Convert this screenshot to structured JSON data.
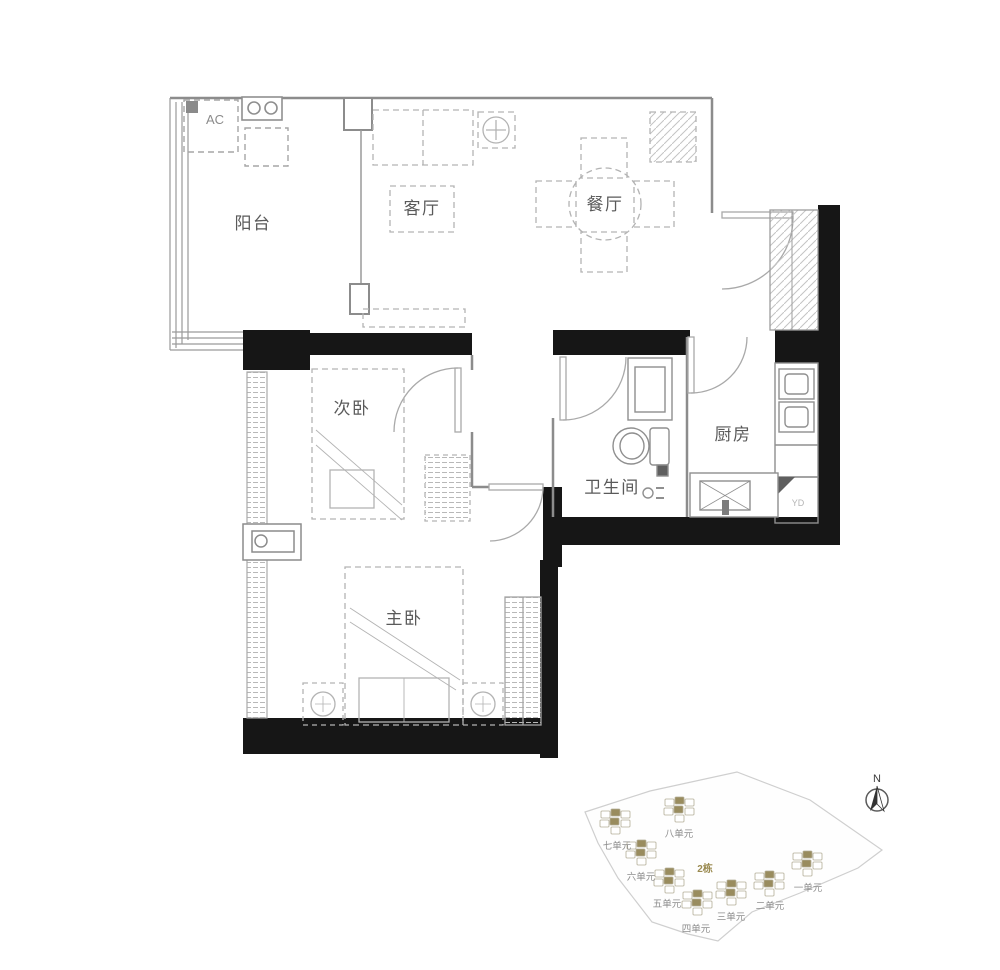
{
  "floor_plan": {
    "rooms": [
      {
        "id": "balcony",
        "label": "阳台"
      },
      {
        "id": "living-room",
        "label": "客厅"
      },
      {
        "id": "dining-room",
        "label": "餐厅"
      },
      {
        "id": "second-bedroom",
        "label": "次卧"
      },
      {
        "id": "bathroom",
        "label": "卫生间"
      },
      {
        "id": "kitchen",
        "label": "厨房"
      },
      {
        "id": "master-bedroom",
        "label": "主卧"
      }
    ],
    "annotations": [
      {
        "id": "ac",
        "label": "AC"
      },
      {
        "id": "yd",
        "label": "YD"
      }
    ],
    "colors": {
      "wall": "#161616",
      "thin_line": "#8c8c8c",
      "furniture": "#b3b3b3",
      "label": "#5a5a5a"
    }
  },
  "site_plan": {
    "building_label": {
      "text": "2栋",
      "color": "#9a8a50",
      "x": 705,
      "y": 872
    },
    "units": [
      {
        "label": "一单元",
        "cx": 806,
        "cy": 862,
        "lx": 808,
        "ly": 891
      },
      {
        "label": "二单元",
        "cx": 768,
        "cy": 882,
        "lx": 770,
        "ly": 909
      },
      {
        "label": "三单元",
        "cx": 730,
        "cy": 891,
        "lx": 731,
        "ly": 920
      },
      {
        "label": "四单元",
        "cx": 696,
        "cy": 901,
        "lx": 696,
        "ly": 932
      },
      {
        "label": "五单元",
        "cx": 668,
        "cy": 879,
        "lx": 667,
        "ly": 907
      },
      {
        "label": "六单元",
        "cx": 640,
        "cy": 851,
        "lx": 641,
        "ly": 880
      },
      {
        "label": "七单元",
        "cx": 614,
        "cy": 820,
        "lx": 617,
        "ly": 849
      },
      {
        "label": "八单元",
        "cx": 678,
        "cy": 808,
        "lx": 679,
        "ly": 837
      }
    ],
    "unit_colors": {
      "filled": "#998c5e",
      "outline": "#b3ad97"
    },
    "compass": {
      "label": "N"
    }
  }
}
